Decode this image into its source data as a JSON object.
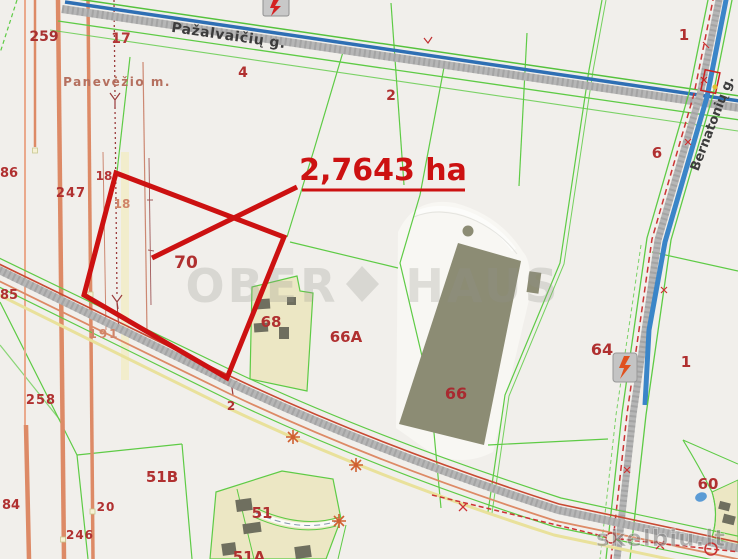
{
  "map": {
    "highlight": {
      "area_label": "2,7643 ha"
    },
    "streets": {
      "top": "Pažalvaičių g.",
      "right": "Bernatonių g."
    },
    "municipality": "Panevėžio m.",
    "parcel_labels": {
      "n259": "259",
      "n17": "17",
      "n4": "4",
      "n2_top": "2",
      "n1_top": "1",
      "n6": "6",
      "n86": "86",
      "n247": "247",
      "n18_a": "18",
      "n18_b": "18",
      "n70": "70",
      "n85": "85",
      "n68": "68",
      "n66a": "66A",
      "n64": "64",
      "n1_mid": "1",
      "n191": "191",
      "n258": "258",
      "n2_road": "2",
      "n66": "66",
      "n51b": "51B",
      "n60": "60",
      "n84": "84",
      "n20": "20",
      "n246": "246",
      "n51": "51",
      "n51a": "51A"
    },
    "watermarks": {
      "center_left": "OBER",
      "center_right": "HAUS",
      "corner": "skelbiu.lt"
    },
    "colors": {
      "highlight_red": "#cc1111",
      "parcel_label": "#b03030",
      "boundary_green": "#5ecb45",
      "road_gray": "#b4b4b4",
      "water_blue": "#3a85c8",
      "utility_salmon": "#dd8a66",
      "built_area_beige": "#ece7c4",
      "building_olive": "#8c8c74"
    }
  }
}
